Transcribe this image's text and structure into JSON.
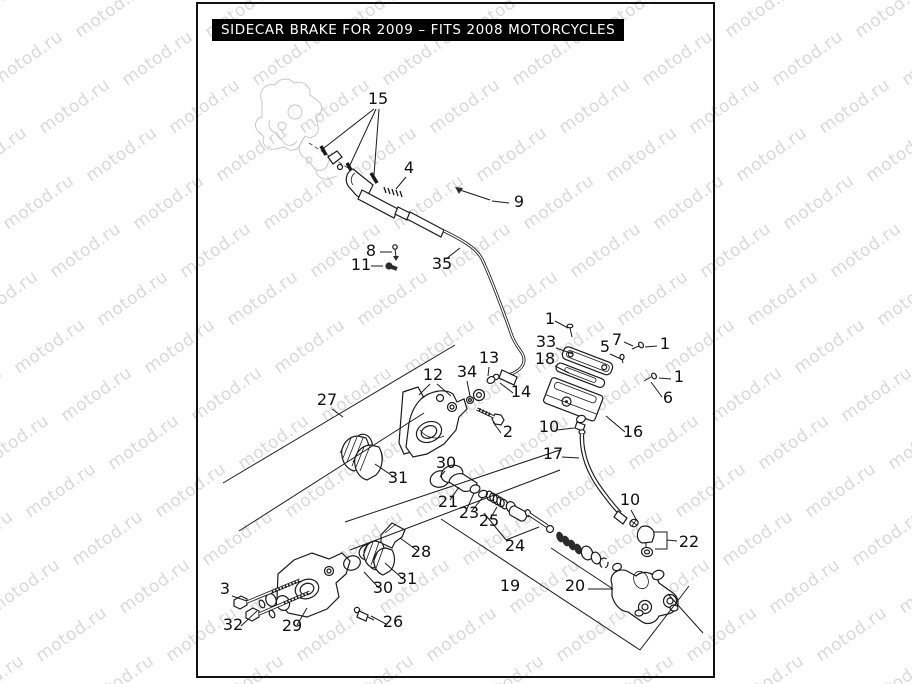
{
  "title": "SIDECAR BRAKE FOR 2009 – FITS 2008 MOTORCYCLES",
  "watermark": {
    "text": "motod.ru",
    "color": "#d9d9d9"
  },
  "colors": {
    "line": "#1a1a1a",
    "frame": "#111111",
    "title_bg": "#000000",
    "title_fg": "#ffffff"
  },
  "diagram": {
    "description": "Exploded parts diagram of a sidecar brake assembly: control cable, caliper halves, brake pads, piston group, fluid reservoir, hose and master cylinder.",
    "part_labels": [
      {
        "id": "p15",
        "n": "15",
        "x": 378,
        "y": 104
      },
      {
        "id": "p4",
        "n": "4",
        "x": 409,
        "y": 173
      },
      {
        "id": "p9",
        "n": "9",
        "x": 519,
        "y": 207
      },
      {
        "id": "p8",
        "n": "8",
        "x": 371,
        "y": 256
      },
      {
        "id": "p11",
        "n": "11",
        "x": 361,
        "y": 270
      },
      {
        "id": "p35",
        "n": "35",
        "x": 442,
        "y": 269
      },
      {
        "id": "p1a",
        "n": "1",
        "x": 550,
        "y": 324
      },
      {
        "id": "p33",
        "n": "33",
        "x": 546,
        "y": 347
      },
      {
        "id": "p18",
        "n": "18",
        "x": 545,
        "y": 364
      },
      {
        "id": "p5",
        "n": "5",
        "x": 605,
        "y": 352
      },
      {
        "id": "p7",
        "n": "7",
        "x": 617,
        "y": 345
      },
      {
        "id": "p1b",
        "n": "1",
        "x": 665,
        "y": 349
      },
      {
        "id": "p1c",
        "n": "1",
        "x": 679,
        "y": 382
      },
      {
        "id": "p6",
        "n": "6",
        "x": 668,
        "y": 403
      },
      {
        "id": "p27",
        "n": "27",
        "x": 327,
        "y": 405
      },
      {
        "id": "p12",
        "n": "12",
        "x": 433,
        "y": 380
      },
      {
        "id": "p34",
        "n": "34",
        "x": 467,
        "y": 377
      },
      {
        "id": "p13",
        "n": "13",
        "x": 489,
        "y": 363
      },
      {
        "id": "p14",
        "n": "14",
        "x": 521,
        "y": 397
      },
      {
        "id": "p2",
        "n": "2",
        "x": 508,
        "y": 437
      },
      {
        "id": "p10a",
        "n": "10",
        "x": 549,
        "y": 432
      },
      {
        "id": "p16",
        "n": "16",
        "x": 633,
        "y": 437
      },
      {
        "id": "p17",
        "n": "17",
        "x": 553,
        "y": 459
      },
      {
        "id": "p30a",
        "n": "30",
        "x": 446,
        "y": 468
      },
      {
        "id": "p31a",
        "n": "31",
        "x": 398,
        "y": 483
      },
      {
        "id": "p21",
        "n": "21",
        "x": 448,
        "y": 507
      },
      {
        "id": "p23",
        "n": "23",
        "x": 469,
        "y": 518
      },
      {
        "id": "p25",
        "n": "25",
        "x": 489,
        "y": 526
      },
      {
        "id": "p10b",
        "n": "10",
        "x": 630,
        "y": 505
      },
      {
        "id": "p22",
        "n": "22",
        "x": 689,
        "y": 547
      },
      {
        "id": "p24",
        "n": "24",
        "x": 515,
        "y": 551
      },
      {
        "id": "p28",
        "n": "28",
        "x": 421,
        "y": 557
      },
      {
        "id": "p19",
        "n": "19",
        "x": 510,
        "y": 591
      },
      {
        "id": "p20",
        "n": "20",
        "x": 575,
        "y": 591
      },
      {
        "id": "p31b",
        "n": "31",
        "x": 407,
        "y": 584
      },
      {
        "id": "p30b",
        "n": "30",
        "x": 383,
        "y": 593
      },
      {
        "id": "p3",
        "n": "3",
        "x": 225,
        "y": 594
      },
      {
        "id": "p32",
        "n": "32",
        "x": 233,
        "y": 630
      },
      {
        "id": "p29",
        "n": "29",
        "x": 292,
        "y": 631
      },
      {
        "id": "p26",
        "n": "26",
        "x": 393,
        "y": 627
      }
    ]
  }
}
